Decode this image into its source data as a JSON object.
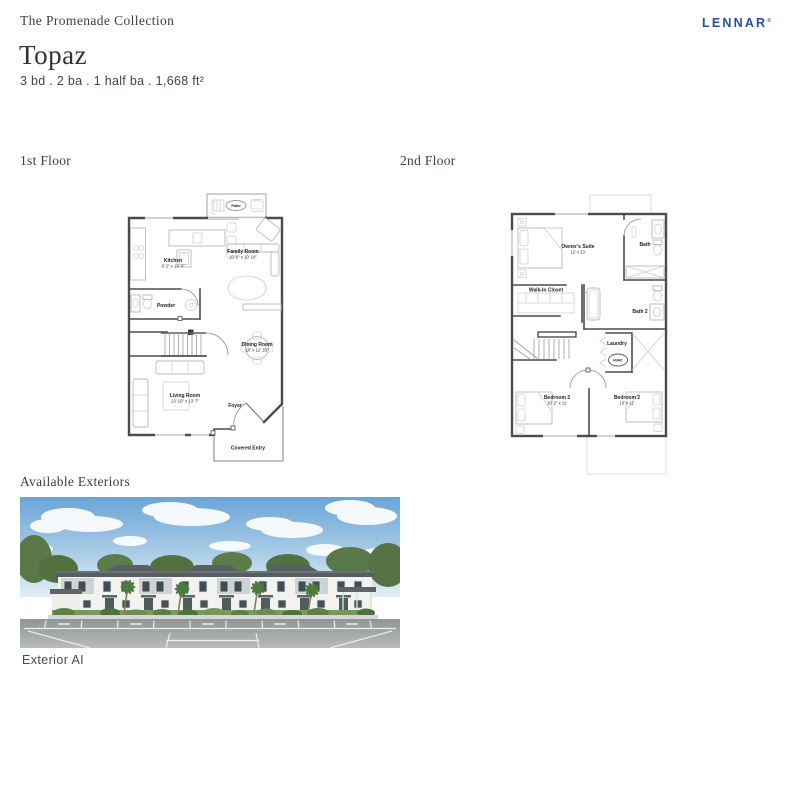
{
  "header": {
    "collection": "The Promenade Collection",
    "brand": "LENNAR",
    "brand_mark": "®",
    "brand_color": "#22549e",
    "plan_name": "Topaz",
    "specs": "3 bd . 2 ba . 1 half ba . 1,668 ft²"
  },
  "floors": {
    "first": {
      "label": "1st Floor",
      "rooms": [
        {
          "name": "Patio",
          "dims": ""
        },
        {
          "name": "Kitchen",
          "dims": "8' 2\" x 13' 4\""
        },
        {
          "name": "Family Room",
          "dims": "10' 6\" x 10' 10\""
        },
        {
          "name": "Powder",
          "dims": ""
        },
        {
          "name": "Dining Room",
          "dims": "10' x 12' 10\""
        },
        {
          "name": "Living Room",
          "dims": "13' 10\" x 13' 7\""
        },
        {
          "name": "Foyer",
          "dims": ""
        },
        {
          "name": "Covered Entry",
          "dims": ""
        }
      ]
    },
    "second": {
      "label": "2nd Floor",
      "rooms": [
        {
          "name": "Owner's Suite",
          "dims": "12' x 13'"
        },
        {
          "name": "Bath",
          "dims": ""
        },
        {
          "name": "Walk-In Closet",
          "dims": ""
        },
        {
          "name": "Bath 2",
          "dims": ""
        },
        {
          "name": "Laundry",
          "dims": ""
        },
        {
          "name": "HVAC",
          "dims": ""
        },
        {
          "name": "Bedroom 3",
          "dims": "10' 2\" x 11'"
        },
        {
          "name": "Bedroom 2",
          "dims": "10' x 11'"
        }
      ]
    }
  },
  "exteriors": {
    "section_label": "Available Exteriors",
    "caption": "Exterior AI",
    "scene": "townhome-row-rendering"
  }
}
